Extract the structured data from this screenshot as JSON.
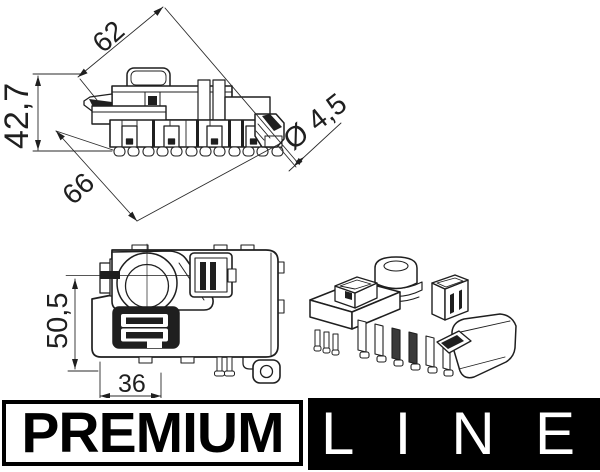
{
  "colors": {
    "ink": "#1f1f1f",
    "background": "#ffffff",
    "banner_black": "#000000",
    "banner_text_light": "#ffffff"
  },
  "side_view": {
    "label_width": "62",
    "label_height": "42,7",
    "label_length": "66",
    "label_hole_diameter": "Ø 4,5"
  },
  "front_view": {
    "label_height": "50,5",
    "label_width": "36"
  },
  "branding": {
    "premium_label": "PREMIUM",
    "line_label": "LINE",
    "line_letters": [
      "L",
      "I",
      "N",
      "E"
    ]
  }
}
